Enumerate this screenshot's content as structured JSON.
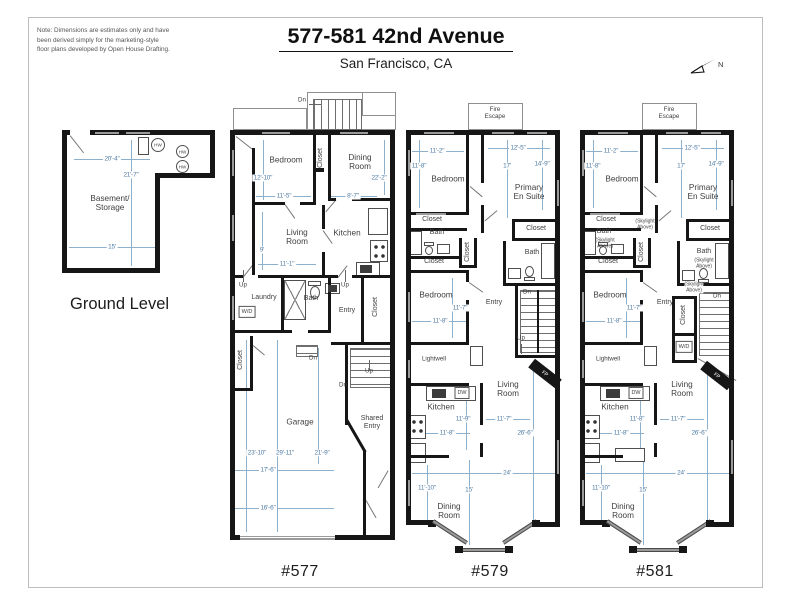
{
  "page": {
    "note": "Note: Dimensions are estimates only and have\nbeen derived simply for the marketing-style\nfloor plans developed by Open House Drafting.",
    "title": "577-581 42nd Avenue",
    "subtitle": "San Francisco, CA",
    "north": "N"
  },
  "labels": {
    "up": "Up",
    "dn": "Dn",
    "closet": "Closet",
    "bath": "Bath",
    "entry": "Entry",
    "bedroom": "Bedroom",
    "kitchen": "Kitchen",
    "wd": "W/D",
    "dw": "DW",
    "hw": "HW",
    "fp": "FP",
    "fire_escape": "Fire\nEscape",
    "skylight": "(Skylight\nAbove)",
    "lightwell": "Lightwell",
    "living": "Living\nRoom",
    "dining": "Dining\nRoom"
  },
  "ground": {
    "title": "Ground Level",
    "room": "Basement/\nStorage",
    "dim_top": "20'-4\"",
    "dim_side": "21'-7\"",
    "dim_bottom": "15'"
  },
  "unit577": {
    "label": "#577",
    "rooms": {
      "laundry": "Laundry",
      "garage": "Garage",
      "shared_entry": "Shared\nEntry"
    },
    "dims": {
      "bedroom_h": "12'-10\"",
      "bedroom_w": "11'-5\"",
      "dining_h": "22'-2\"",
      "dining_w": "8'-7\"",
      "living_h": "9'",
      "living_w": "11'-1\"",
      "garage_h1": "23'-10\"",
      "garage_h2": "29'-11\"",
      "garage_h3": "21'-9\"",
      "garage_w1": "17'-6\"",
      "garage_w2": "16'-6\""
    }
  },
  "unit579": {
    "label": "#579",
    "rooms": {
      "primary": "Primary\nEn Suite"
    },
    "dims": {
      "bedroom_w": "11'-2\"",
      "bedroom_h": "11'-8\"",
      "primary_w": "12'-5\"",
      "primary_h1": "17'",
      "primary_h2": "14'-9\"",
      "bedroom2_h": "11'-7\"",
      "bedroom2_w": "11'-8\"",
      "kitchen_h": "11'-9\"",
      "kitchen_w": "11'-8\"",
      "living_w": "11'-7\"",
      "living_h": "26'-6\"",
      "width_total": "24'",
      "dining_w1": "11'-10\"",
      "dining_w2": "15'"
    }
  },
  "unit581": {
    "label": "#581",
    "rooms": {
      "primary": "Primary\nEn Suite"
    },
    "dims": {
      "bedroom_w": "11'-2\"",
      "bedroom_h": "11'-8\"",
      "primary_w": "12'-5\"",
      "primary_h1": "17'",
      "primary_h2": "14'-9\"",
      "bedroom2_h": "11'-7\"",
      "bedroom2_w": "11'-8\"",
      "kitchen_h": "11'-8\"",
      "kitchen_w": "11'-8\"",
      "living_w": "11'-7\"",
      "living_h": "26'-6\"",
      "width_total": "24'",
      "dining_w1": "11'-10\"",
      "dining_w2": "15'"
    }
  }
}
